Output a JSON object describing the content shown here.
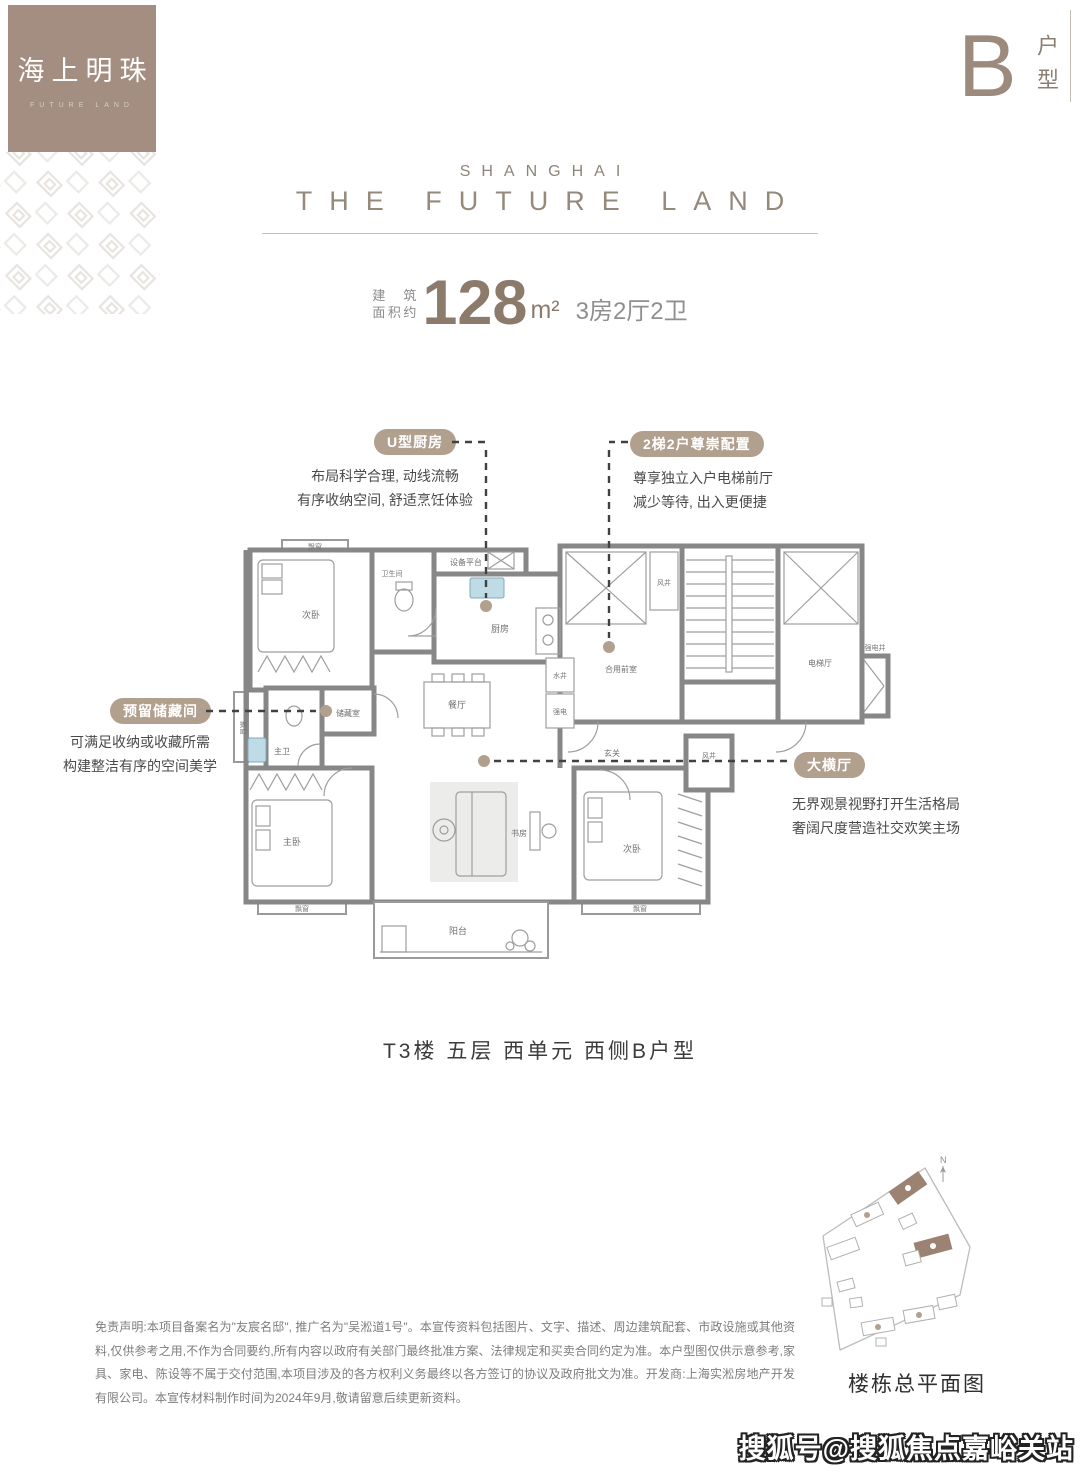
{
  "logo": {
    "name": "海上明珠",
    "subtitle": "FUTURE LAND"
  },
  "unit_tag": {
    "letter": "B",
    "label": "户型"
  },
  "header": {
    "kicker": "SHANGHAI",
    "title": "THE FUTURE LAND"
  },
  "area": {
    "prefix_line1": "建 筑",
    "prefix_line2": "面积约",
    "value": "128",
    "unit": "m²",
    "rooms": "3房2厅2卫"
  },
  "callouts": [
    {
      "badge": "U型厨房",
      "line1": "布局科学合理, 动线流畅",
      "line2": "有序收纳空间, 舒适烹饪体验"
    },
    {
      "badge": "2梯2户尊崇配置",
      "line1": "尊享独立入户电梯前厅",
      "line2": "减少等待, 出入更便捷"
    },
    {
      "badge": "预留储藏间",
      "line1": "可满足收纳或收藏所需",
      "line2": "构建整洁有序的空间美学"
    },
    {
      "badge": "大横厅",
      "line1": "无界观景视野打开生活格局",
      "line2": "奢阔尺度营造社交欢笑主场"
    }
  ],
  "floorplan": {
    "caption": "T3楼 五层 西单元 西侧B户型",
    "rooms": {
      "bay": "飘窗",
      "bed_top": "次卧",
      "bath": "卫生间",
      "equip": "设备平台",
      "kitchen": "厨房",
      "windwell": "风井",
      "vestibule": "合用前室",
      "elev_hall": "电梯厅",
      "elec_shaft": "强电井",
      "water_shaft": "水井",
      "elec": "强电",
      "dining": "餐厅",
      "storage": "储藏室",
      "master_bath": "主卫",
      "foyer": "玄关",
      "master_bed": "主卧",
      "study": "书房",
      "bed_right": "次卧",
      "balcony": "阳台"
    }
  },
  "siteplan": {
    "caption": "楼栋总平面图",
    "north": "N"
  },
  "disclaimer": "免责声明:本项目备案名为\"友宸名邸\", 推广名为\"吴淞道1号\"。本宣传资料包括图片、文字、描述、周边建筑配套、市政设施或其他资料,仅供参考之用,不作为合同要约,所有内容以政府有关部门最终批准方案、法律规定和买卖合同约定为准。本户型图仅供示意参考,家具、家电、陈设等不属于交付范围,本项目涉及的各方权利义务最终以各方签订的协议及政府批文为准。开发商:上海实淞房地产开发有限公司。本宣传材料制作时间为2024年9月,敬请留意后续更新资料。",
  "watermark": "搜狐号@搜狐焦点嘉峪关站"
}
